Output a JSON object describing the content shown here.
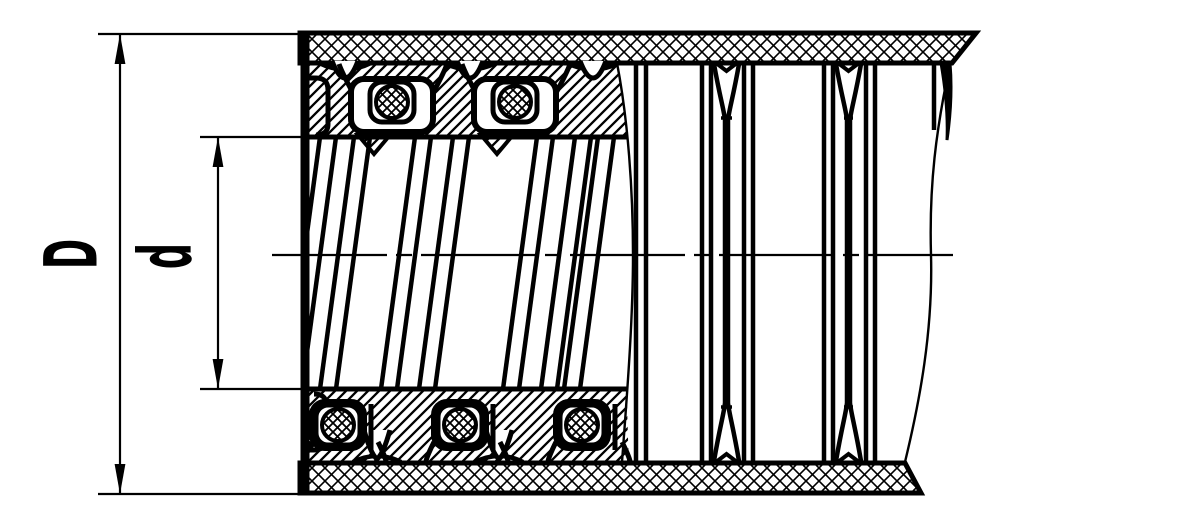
{
  "figure": {
    "kind": "engineering-section-drawing",
    "subject": "flexible interlocked metal hose, longitudinal section",
    "background_color": "#ffffff",
    "ink_color": "#000000"
  },
  "dimensions": {
    "outer_diameter": {
      "label": "D"
    },
    "inner_diameter": {
      "label": "d"
    }
  },
  "patterns": [
    {
      "name": "braid-crosshatch-pattern"
    },
    {
      "name": "packing-diagonal-hatch-pattern"
    },
    {
      "name": "gasket-crosshatch-pattern"
    }
  ]
}
